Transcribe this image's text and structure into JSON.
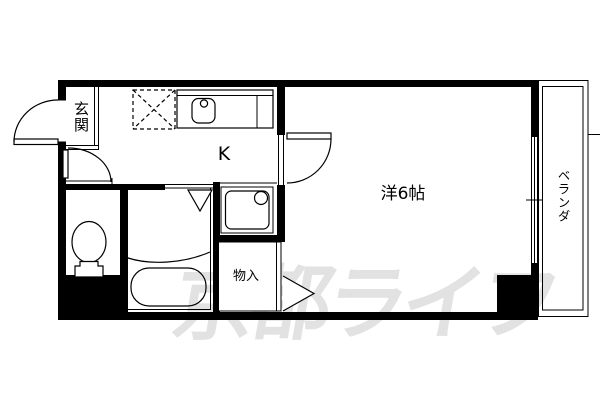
{
  "floorplan": {
    "title": "apartment-floorplan-1K",
    "rooms": {
      "entrance": "玄関",
      "kitchen": "K",
      "western_room": "洋6帖",
      "closet": "物入",
      "veranda": "ベランダ"
    },
    "watermark": "京都ライフ",
    "colors": {
      "wall": "#000000",
      "background": "#ffffff",
      "watermark": "#e2e2e2",
      "line": "#000000"
    }
  }
}
